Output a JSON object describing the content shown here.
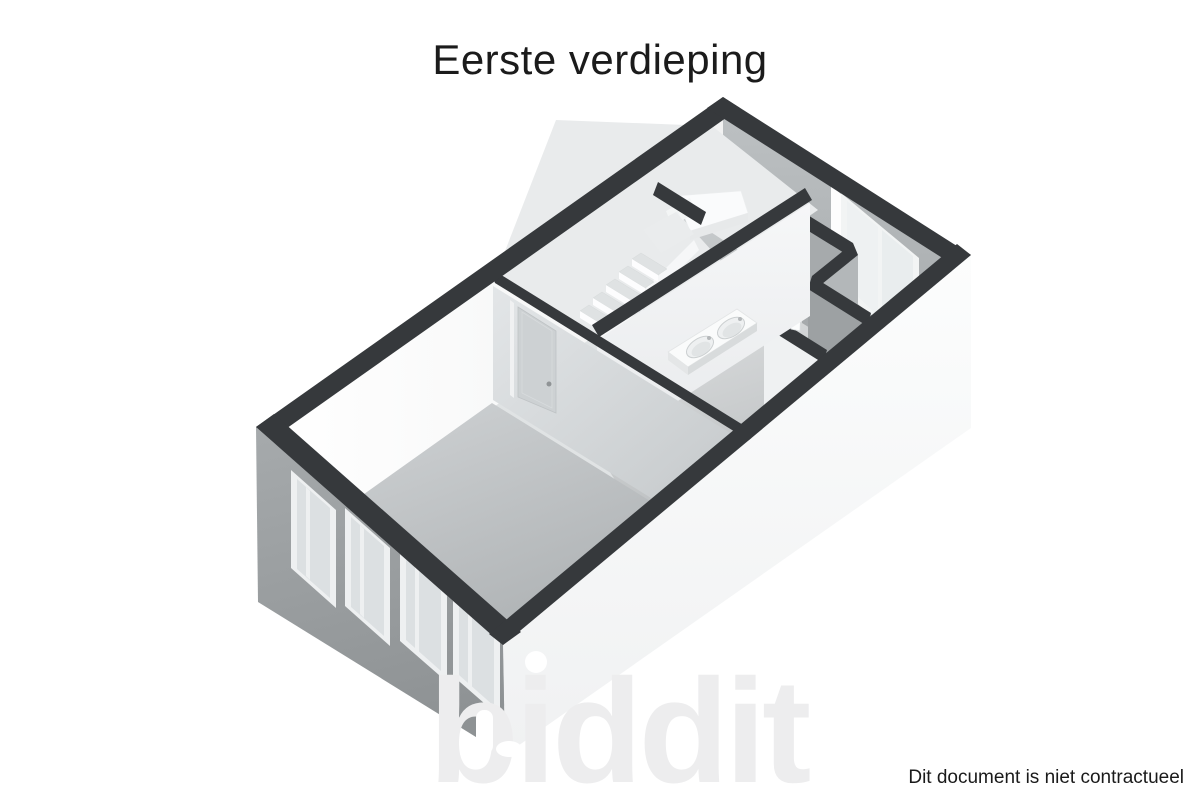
{
  "header": {
    "title": "Eerste verdieping"
  },
  "footer": {
    "disclaimer": "Dit document is niet contractueel"
  },
  "watermark": {
    "text": "biddit"
  },
  "palette": {
    "background": "#ffffff",
    "wall_top_band": "#36393c",
    "facade_sw": "#9ba0a2",
    "facade_se": "#f7f8f9",
    "interior_wall_light": "#f5f6f7",
    "interior_wall_shadow": "#a6aaac",
    "floor_gray": "#b5b9bb",
    "text_color": "#1b1b1b"
  },
  "floorplan": {
    "view": "3d-perspective-floor-plan",
    "features": [
      "staircase-with-landing",
      "double-washbasin",
      "interior-door-closed",
      "two-pane-window-ne-wall",
      "four-facade-windows-sw-wall",
      "glass-door-panel"
    ]
  }
}
